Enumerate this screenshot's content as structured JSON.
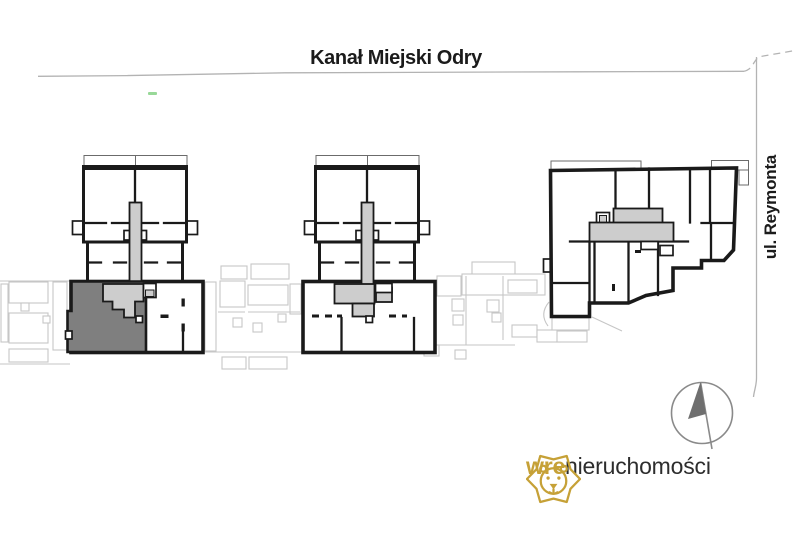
{
  "labels": {
    "canal": "Kanał Miejski Odry",
    "street": "ul. Reymonta"
  },
  "logo": {
    "prefix": "wre",
    "suffix": "nieruchomości"
  },
  "icons": {
    "lion": "lion-logo-icon",
    "compass": "north-arrow-compass-icon"
  },
  "colors": {
    "outline": "#1a1a1a",
    "unit-highlight": "#7f7f7f",
    "stairwell": "#cdcdcd",
    "faint": "#c6c6c6",
    "guide": "#b3b3b3",
    "gold": "#C6A137",
    "logo-text": "#2d2d2d",
    "compass": "#8a8a8a",
    "needle": "#6f6f6f",
    "green-mark": "#86d186"
  }
}
